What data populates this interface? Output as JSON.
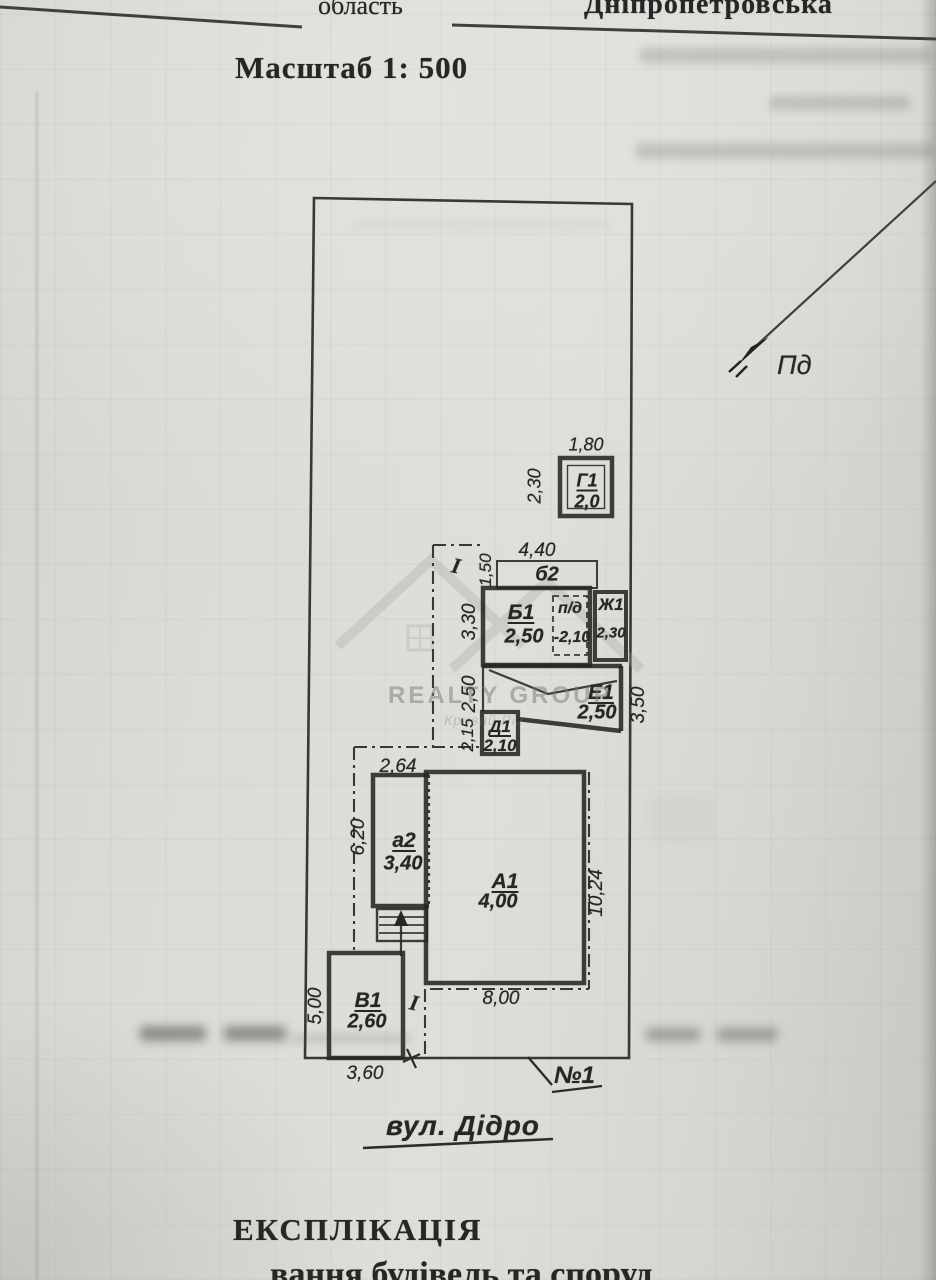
{
  "header": {
    "region_label": "область",
    "region_value": "Дніпропетровська",
    "scale": "Масштаб 1: 500"
  },
  "compass": {
    "south_label": "Пд"
  },
  "watermark": {
    "brand": "REALTY GROUP",
    "city": "Кривий Ріг"
  },
  "plan": {
    "street": "вул. Дідро",
    "plot_no": "№1",
    "fence_mark_top": "I",
    "fence_mark_bottom": "I",
    "buildings": {
      "g1": {
        "label": "Г1",
        "value": "2,0"
      },
      "b2": {
        "label": "б2"
      },
      "b1": {
        "label": "Б1",
        "value": "2,50"
      },
      "pd": {
        "label": "п/д",
        "value": "-2,10"
      },
      "zh1": {
        "label": "Ж1",
        "value": "2,30"
      },
      "e1": {
        "label": "Е1",
        "value": "2,50"
      },
      "d1": {
        "label": "Д1",
        "value": "2,10"
      },
      "a2": {
        "label": "а2",
        "value": "3,40"
      },
      "a1": {
        "label": "А1",
        "value": "4,00"
      },
      "v1": {
        "label": "В1",
        "value": "2,60"
      }
    },
    "dims": {
      "g1_w": "1,80",
      "g1_h": "2,30",
      "b2_w": "4,40",
      "b2_h": "1,50",
      "b1_h": "3,30",
      "e1_left": "2,50",
      "d1_left": "2,15",
      "e1_right": "3,50",
      "a2_w": "2,64",
      "a2_left": "6,20",
      "a1_right": "10,24",
      "a1_w": "8,00",
      "v1_left": "5,00",
      "v1_w": "3,60"
    }
  },
  "footer": {
    "title": "ЕКСПЛІКАЦІЯ",
    "subtitle_fragment": "вання будівель та споруд"
  }
}
